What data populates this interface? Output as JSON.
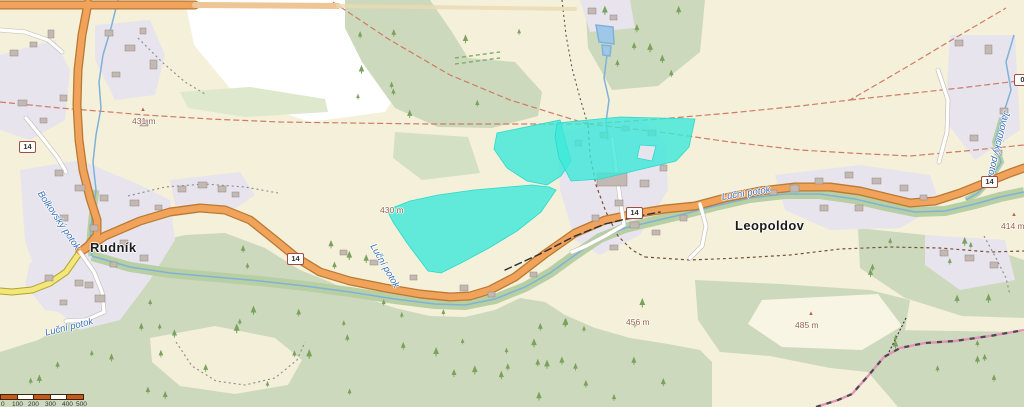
{
  "map": {
    "towns": {
      "rudnik": "Rudník",
      "leopoldov": "Leopoldov"
    },
    "streams": {
      "bolkovsky": "Bolkovský potok",
      "lucni_west": "Luční potok",
      "lucni_mid": "Luční potok",
      "lucni_east": "Luční potok",
      "javornicky": "Javornický potok"
    },
    "elevations": {
      "peak_nw": "431 m",
      "peak_s": "485 m",
      "peak_e": "414 m",
      "spot_mid": "430 m",
      "spot_se": "456 m"
    },
    "road": {
      "ref": "14",
      "ref_clipped": "0"
    },
    "scalebar": {
      "labels": [
        "0",
        "100",
        "200",
        "300",
        "400",
        "500"
      ]
    },
    "highlight": {
      "color": "#3ce8d8",
      "area_count": 3
    },
    "colors": {
      "road_primary": "#f1a25b",
      "road_secondary": "#f3e77c",
      "water": "#7fb2d9",
      "forest": "#cdd9bc",
      "residential": "#e7e4ee",
      "boundary": "#cf7b66",
      "highlight": "#3ce8d8"
    }
  }
}
